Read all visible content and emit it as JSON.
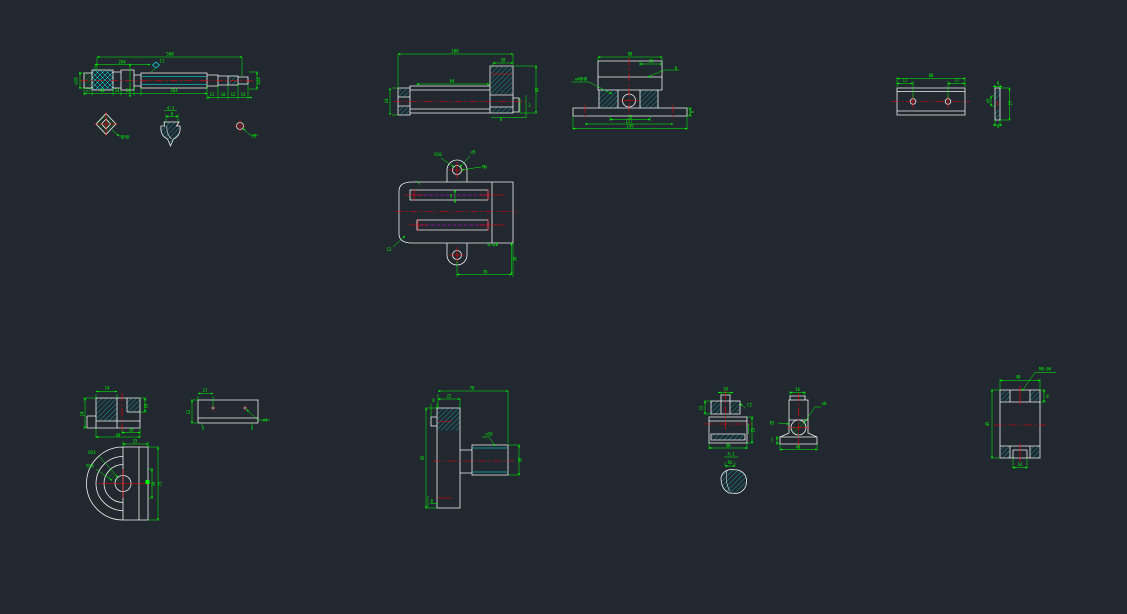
{
  "canvas": {
    "background": "#212830",
    "line_colors": {
      "outline": "#f2f2f2",
      "dimension": "#00ff00",
      "centerline": "#ff0000",
      "section_hatch": "#00ffff",
      "slot_centerline": "#ff00ff"
    }
  },
  "views": [
    {
      "id": "shaft",
      "title": "shaft-front-view",
      "labels": [
        {
          "x": 170,
          "y": 55.5,
          "t": "500"
        },
        {
          "x": 122,
          "y": 63.5,
          "t": "204"
        },
        {
          "x": 162,
          "y": 62.5,
          "t": "C1"
        },
        {
          "x": 88,
          "y": 92,
          "t": "17"
        },
        {
          "x": 102,
          "y": 92,
          "t": "30"
        },
        {
          "x": 117,
          "y": 92,
          "t": "14"
        },
        {
          "x": 128,
          "y": 92,
          "t": "24"
        },
        {
          "x": 174,
          "y": 92,
          "t": "264"
        },
        {
          "x": 212,
          "y": 96,
          "t": "11"
        },
        {
          "x": 223,
          "y": 96,
          "t": "10"
        },
        {
          "x": 233,
          "y": 96,
          "t": "12"
        },
        {
          "x": 243,
          "y": 96,
          "t": "14"
        },
        {
          "x": 260,
          "y": 81,
          "t": "⌀24",
          "r": -90
        },
        {
          "x": 77.5,
          "y": 81,
          "t": "⌀18",
          "r": -90
        }
      ]
    },
    {
      "id": "detail-b",
      "title": "shaft-section-detail",
      "labels": [
        {
          "x": 125,
          "y": 139,
          "t": "B-B"
        }
      ]
    },
    {
      "id": "detail-tooth",
      "title": "thread-profile-detail",
      "labels": [
        {
          "x": 170.5,
          "y": 109.5,
          "t": "4:1"
        },
        {
          "x": 172,
          "y": 115.5,
          "t": "6"
        }
      ]
    },
    {
      "id": "detail-hole",
      "title": "hole-detail",
      "labels": [
        {
          "x": 254,
          "y": 137.5,
          "t": "⌀3"
        }
      ]
    },
    {
      "id": "bushing",
      "title": "bushing-section-view",
      "labels": [
        {
          "x": 455,
          "y": 52.5,
          "t": "108"
        },
        {
          "x": 503,
          "y": 61.5,
          "t": "20"
        },
        {
          "x": 452,
          "y": 82.5,
          "t": "64"
        },
        {
          "x": 538.5,
          "y": 90,
          "t": "45",
          "r": -90
        },
        {
          "x": 388,
          "y": 101,
          "t": "24",
          "r": -90
        },
        {
          "x": 501,
          "y": 121,
          "t": "8"
        },
        {
          "x": 529.5,
          "y": 107,
          "t": "3"
        }
      ]
    },
    {
      "id": "pedestal",
      "title": "pedestal-front-view",
      "labels": [
        {
          "x": 630,
          "y": 55.5,
          "t": "88"
        },
        {
          "x": 651,
          "y": 62.5,
          "t": "30"
        },
        {
          "x": 676,
          "y": 69.5,
          "t": "6"
        },
        {
          "x": 581,
          "y": 80.5,
          "t": "⌀40H8"
        },
        {
          "x": 630,
          "y": 118.5,
          "t": "56"
        },
        {
          "x": 629,
          "y": 123,
          "t": "117"
        },
        {
          "x": 630,
          "y": 127.5,
          "t": "145"
        },
        {
          "x": 693.5,
          "y": 112,
          "t": "8",
          "r": -90
        }
      ]
    },
    {
      "id": "bar",
      "title": "clamp-bar-views",
      "labels": [
        {
          "x": 931,
          "y": 77,
          "t": "80"
        },
        {
          "x": 905,
          "y": 82,
          "t": "17"
        },
        {
          "x": 957,
          "y": 82,
          "t": "17"
        },
        {
          "x": 998,
          "y": 84.5,
          "t": "6"
        },
        {
          "x": 1012,
          "y": 103,
          "t": "27",
          "r": -90
        },
        {
          "x": 989.5,
          "y": 101,
          "t": "⌀5",
          "r": -90
        },
        {
          "x": 998,
          "y": 128,
          "t": "4"
        }
      ]
    },
    {
      "id": "bracket",
      "title": "bracket-top-view",
      "labels": [
        {
          "x": 438,
          "y": 156,
          "t": "R10"
        },
        {
          "x": 473,
          "y": 153.5,
          "t": "⌀9"
        },
        {
          "x": 484.5,
          "y": 168.5,
          "t": "M6"
        },
        {
          "x": 451,
          "y": 197.5,
          "t": "8"
        },
        {
          "x": 389,
          "y": 251,
          "t": "C2"
        },
        {
          "x": 485,
          "y": 273.5,
          "t": "78"
        },
        {
          "x": 516.5,
          "y": 259,
          "t": "30",
          "r": -90
        },
        {
          "x": 497,
          "y": 246,
          "t": "6"
        }
      ]
    },
    {
      "id": "section-small",
      "title": "block-section-view",
      "labels": [
        {
          "x": 107,
          "y": 389.5,
          "t": "14"
        },
        {
          "x": 83.5,
          "y": 414,
          "t": "24",
          "r": -90
        },
        {
          "x": 147.5,
          "y": 406,
          "t": "10",
          "r": -90
        },
        {
          "x": 131,
          "y": 431.5,
          "t": "18"
        },
        {
          "x": 118,
          "y": 436.5,
          "t": "44"
        }
      ]
    },
    {
      "id": "plate-side",
      "title": "plate-side-view",
      "labels": [
        {
          "x": 205,
          "y": 392,
          "t": "17"
        },
        {
          "x": 190,
          "y": 412,
          "t": "12",
          "r": -90
        },
        {
          "x": 265,
          "y": 421.5,
          "t": "⌀4"
        },
        {
          "x": 203,
          "y": 430,
          "t": "3"
        },
        {
          "x": 252,
          "y": 430,
          "t": "3"
        }
      ]
    },
    {
      "id": "housing",
      "title": "bearing-housing-view",
      "labels": [
        {
          "x": 92,
          "y": 454,
          "t": "R24"
        },
        {
          "x": 90,
          "y": 467.5,
          "t": "R18"
        },
        {
          "x": 135,
          "y": 442.5,
          "t": "25"
        },
        {
          "x": 161.5,
          "y": 484,
          "t": "73",
          "r": -90
        },
        {
          "x": 155,
          "y": 484,
          "t": "26",
          "r": -90
        }
      ]
    },
    {
      "id": "bolt-plate",
      "title": "plate-with-boss-views",
      "labels": [
        {
          "x": 472,
          "y": 389.5,
          "t": "70"
        },
        {
          "x": 449,
          "y": 397.5,
          "t": "22"
        },
        {
          "x": 433.5,
          "y": 402,
          "t": "8"
        },
        {
          "x": 424,
          "y": 458,
          "t": "95",
          "r": -90
        },
        {
          "x": 521.5,
          "y": 460,
          "t": "30",
          "r": -90
        },
        {
          "x": 489,
          "y": 435.5,
          "t": "⌀36"
        },
        {
          "x": 432,
          "y": 502.5,
          "t": "6"
        }
      ]
    },
    {
      "id": "stud-section",
      "title": "stud-block-section",
      "labels": [
        {
          "x": 725.5,
          "y": 390.5,
          "t": "10"
        },
        {
          "x": 702.5,
          "y": 408,
          "t": "12",
          "r": -90
        },
        {
          "x": 749.5,
          "y": 406.5,
          "t": "C2"
        },
        {
          "x": 754.5,
          "y": 430,
          "t": "25",
          "r": -90
        },
        {
          "x": 728,
          "y": 447,
          "t": "40"
        }
      ]
    },
    {
      "id": "pivot",
      "title": "pivot-base-view",
      "labels": [
        {
          "x": 797.5,
          "y": 391,
          "t": "16"
        },
        {
          "x": 824,
          "y": 405,
          "t": "⌀8"
        },
        {
          "x": 772,
          "y": 424.5,
          "t": "R3"
        },
        {
          "x": 798,
          "y": 448.5,
          "t": "40"
        },
        {
          "x": 772,
          "y": 442,
          "t": "7"
        }
      ]
    },
    {
      "id": "detail-41",
      "title": "detail-4-1",
      "labels": [
        {
          "x": 731,
          "y": 455.5,
          "t": "4:1"
        },
        {
          "x": 730,
          "y": 464,
          "t": "R2"
        }
      ]
    },
    {
      "id": "sleeve",
      "title": "sleeve-section-view",
      "labels": [
        {
          "x": 1045,
          "y": 370.5,
          "t": "M8-6H"
        },
        {
          "x": 1018,
          "y": 378.5,
          "t": "40"
        },
        {
          "x": 1047.5,
          "y": 398,
          "t": "8"
        },
        {
          "x": 989,
          "y": 424,
          "t": "45",
          "r": -90
        },
        {
          "x": 1020,
          "y": 466,
          "t": "14"
        }
      ]
    }
  ]
}
